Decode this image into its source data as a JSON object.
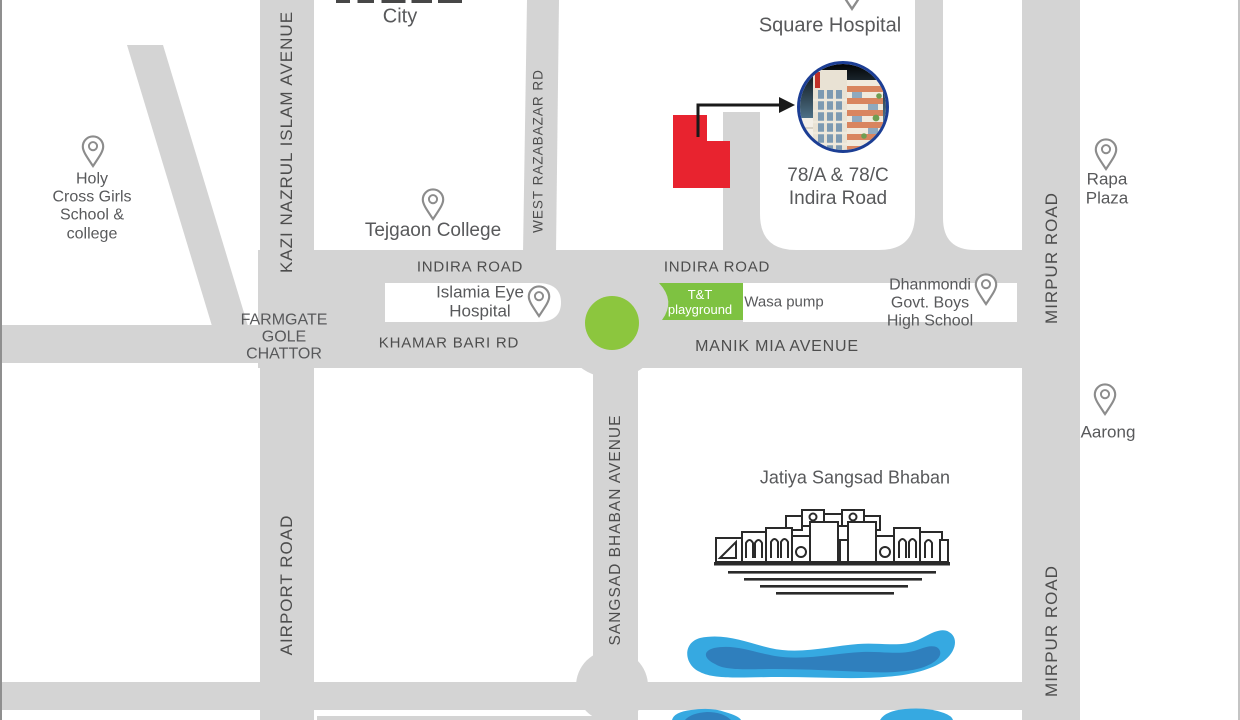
{
  "colors": {
    "road": "#d4d4d4",
    "road_text": "#4d4d4d",
    "place_text": "#58595b",
    "green_circle": "#8cc63e",
    "green_box": "#7ec241",
    "red": "#e8232f",
    "water_light": "#36a9e1",
    "water_dark": "#2f7fbd",
    "photo_ring": "#1c3e94",
    "pin": "#8c8c8c"
  },
  "roads": {
    "kazi_nazrul": "KAZI NAZRUL ISLAM AVENUE",
    "west_razabazar": "WEST RAZABAZAR RD",
    "indira_west": "INDIRA ROAD",
    "indira_east": "INDIRA ROAD",
    "khamar_bari": "KHAMAR BARI RD",
    "manik_mia": "MANIK MIA AVENUE",
    "mirpur_upper": "MIRPUR ROAD",
    "mirpur_lower": "MIRPUR ROAD",
    "airport": "AIRPORT ROAD",
    "sangsad_avenue": "SANGSAD BHABAN AVENUE"
  },
  "junction": {
    "farmgate": [
      "FARMGATE",
      "GOLE",
      "CHATTOR"
    ]
  },
  "places": {
    "city_partial": "City",
    "square_hospital": "Square Hospital",
    "holy_cross": [
      "Holy",
      "Cross Girls",
      "School &",
      "college"
    ],
    "tejgaon": "Tejgaon College",
    "islamia": [
      "Islamia Eye",
      "Hospital"
    ],
    "tnt_playground": [
      "T&T",
      "playground"
    ],
    "wasa_pump": "Wasa pump",
    "dhanmondi": [
      "Dhanmondi",
      "Govt. Boys",
      "High School"
    ],
    "rapa_plaza": [
      "Rapa",
      "Plaza"
    ],
    "aarong": "Aarong",
    "jatiya_sangsad": "Jatiya Sangsad Bhaban",
    "property": [
      "78/A & 78/C",
      "Indira Road"
    ]
  }
}
